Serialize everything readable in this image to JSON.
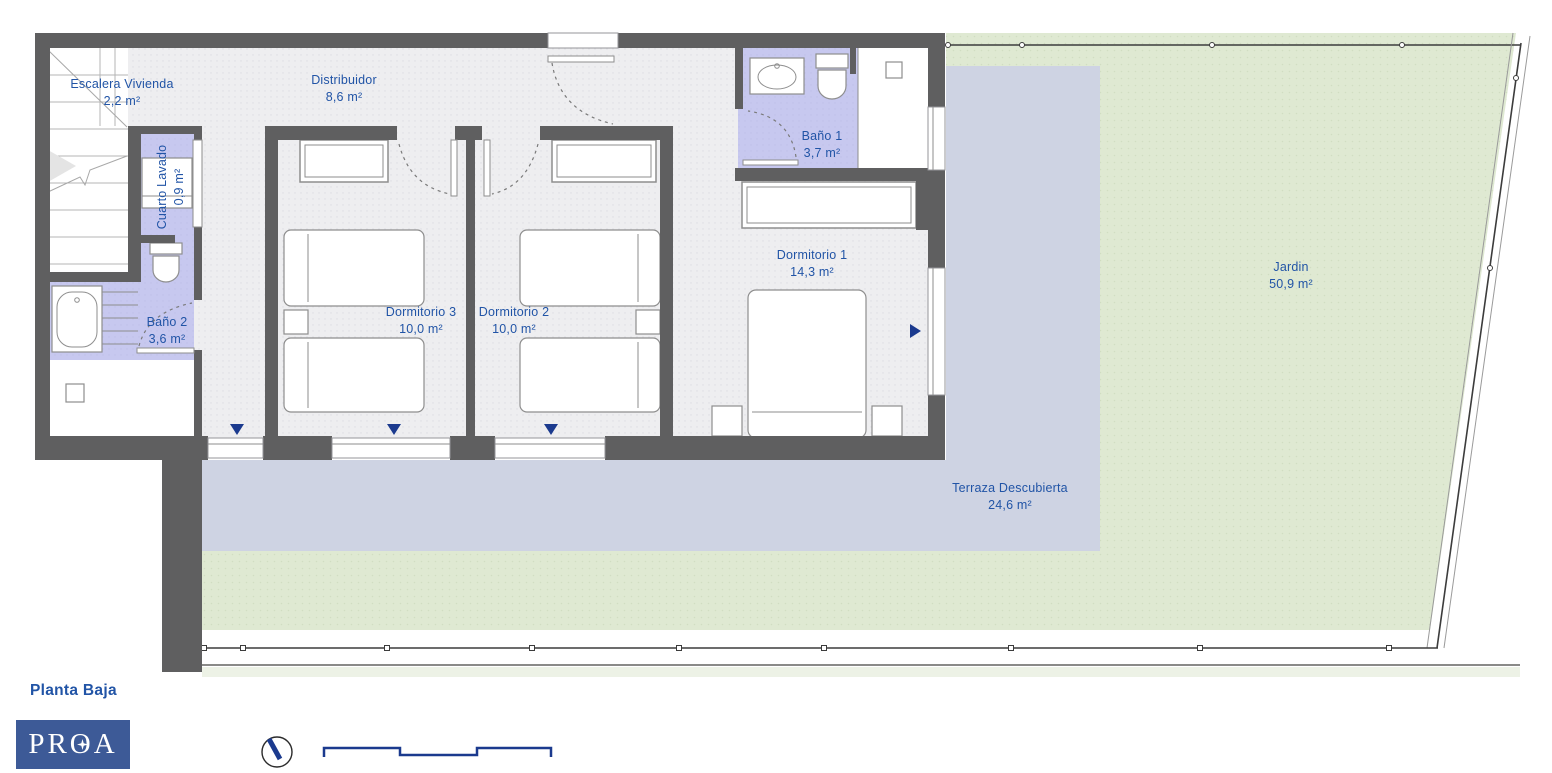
{
  "plan": {
    "title": "Planta Baja",
    "rooms": [
      {
        "name": "Escalera Vivienda",
        "area": "2,2 m²"
      },
      {
        "name": "Cuarto Lavado",
        "area": "0,9 m²"
      },
      {
        "name": "Distribuidor",
        "area": "8,6 m²"
      },
      {
        "name": "Baño 1",
        "area": "3,7 m²"
      },
      {
        "name": "Baño 2",
        "area": "3,6 m²"
      },
      {
        "name": "Dormitorio 1",
        "area": "14,3 m²"
      },
      {
        "name": "Dormitorio 2",
        "area": "10,0 m²"
      },
      {
        "name": "Dormitorio 3",
        "area": "10,0 m²"
      },
      {
        "name": "Terraza Descubierta",
        "area": "24,6 m²"
      },
      {
        "name": "Jardin",
        "area": "50,9 m²"
      }
    ]
  },
  "footer": {
    "logo_text": "PROA"
  },
  "colors": {
    "wall": "#5f5f60",
    "floor": "#eeeef0",
    "bath": "#c7c8ef",
    "terrace": "#ced3e3",
    "garden": "#dfe9d2",
    "garden_light": "#edf2e6",
    "label": "#2154a6",
    "navy": "#1b3a8e",
    "logo_bg": "#3d5a97",
    "fence": "#3c3c3c",
    "fixture_stroke": "#8e8e8e"
  }
}
